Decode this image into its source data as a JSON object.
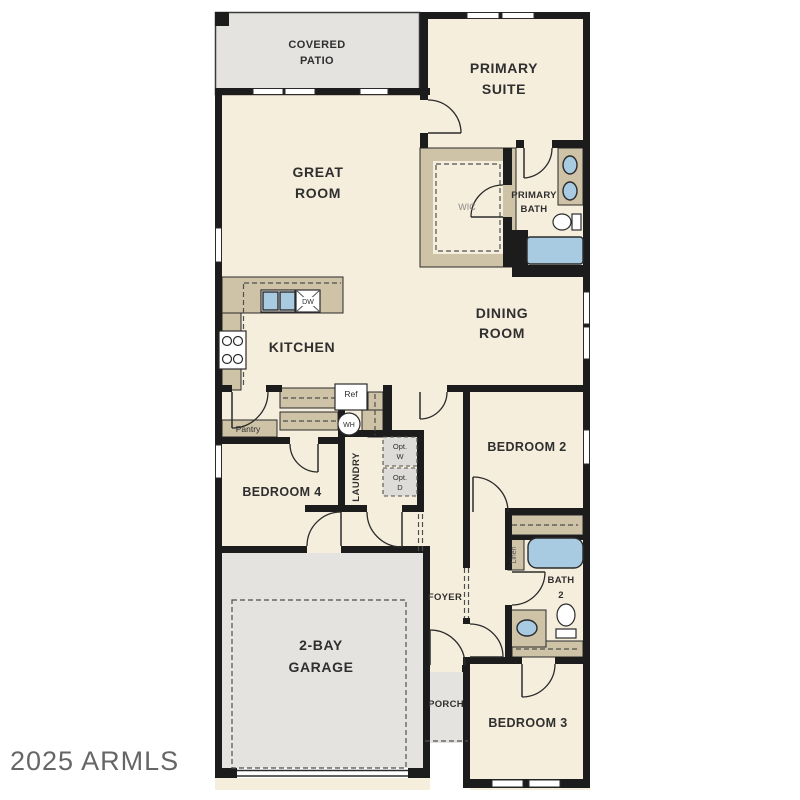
{
  "palette": {
    "wall": "#1c1c1c",
    "room": "#f6eedd",
    "gray": "#e4e3e0",
    "tan": "#cec2a7",
    "blue": "#a9cbe2",
    "line": "#2b2b2b",
    "label": "#2f2f2f",
    "muted": "#8a8a8a",
    "watermark": "#4c4c4c"
  },
  "watermark": "2025 ARMLS",
  "rooms": {
    "covered_patio": {
      "l1": "COVERED",
      "l2": "PATIO"
    },
    "primary_suite": {
      "l1": "PRIMARY",
      "l2": "SUITE"
    },
    "great_room": {
      "l1": "GREAT",
      "l2": "ROOM"
    },
    "wic": "WIC",
    "primary_bath": {
      "l1": "PRIMARY",
      "l2": "BATH"
    },
    "dining_room": {
      "l1": "DINING",
      "l2": "ROOM"
    },
    "kitchen": "KITCHEN",
    "pantry": "Pantry",
    "laundry": "LAUNDRY",
    "bedroom4": "BEDROOM 4",
    "bedroom2": "BEDROOM 2",
    "linen": "Linen",
    "bath2": {
      "l1": "BATH",
      "l2": "2"
    },
    "foyer": "FOYER",
    "garage": {
      "l1": "2-BAY",
      "l2": "GARAGE"
    },
    "porch": "PORCH",
    "bedroom3": "BEDROOM 3"
  },
  "fixtures": {
    "ref": "Ref",
    "dw": "DW",
    "wh": "WH",
    "opt_w": {
      "l1": "Opt.",
      "l2": "W"
    },
    "opt_d": {
      "l1": "Opt.",
      "l2": "D"
    }
  }
}
